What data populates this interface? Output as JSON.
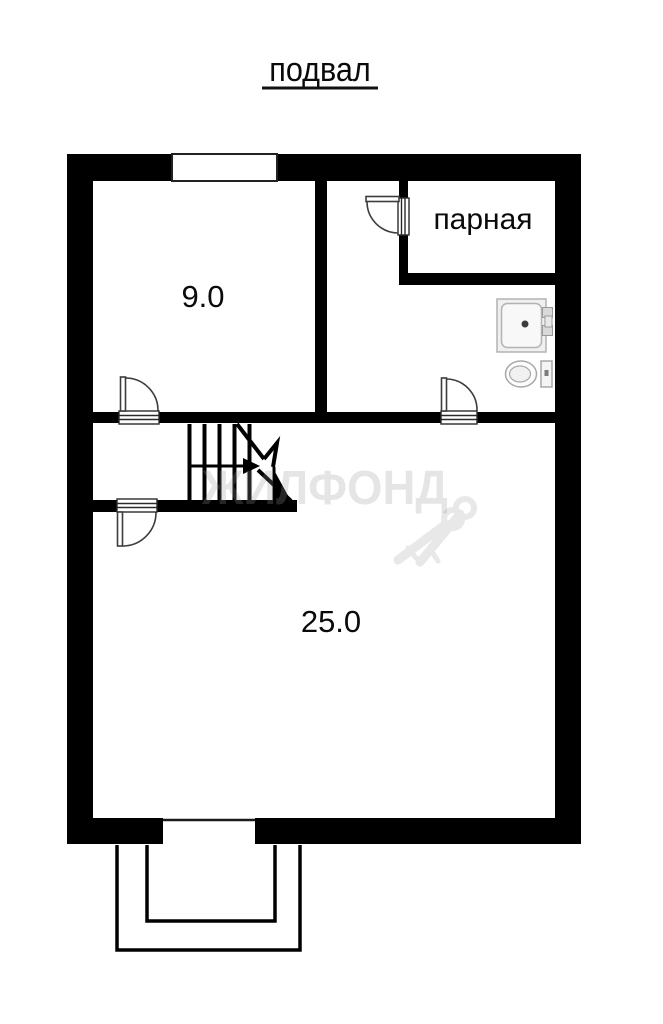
{
  "plan": {
    "title": "подвал",
    "rooms": {
      "top_left": {
        "area": "9.0"
      },
      "steam": {
        "name": "парная"
      },
      "main": {
        "area": "25.0"
      }
    },
    "watermark": "ЖИЛФОНД"
  },
  "colors": {
    "wall": "#000000",
    "door": "#3d3d3d",
    "stair": "#000000",
    "fixture_stroke": "#a8a8a8",
    "fixture_fill": "#f0f0f0",
    "watermark_text": "rgba(150,150,150,0.25)",
    "watermark_icon": "#e8e8e8",
    "label_text": "#0a0a0a"
  }
}
